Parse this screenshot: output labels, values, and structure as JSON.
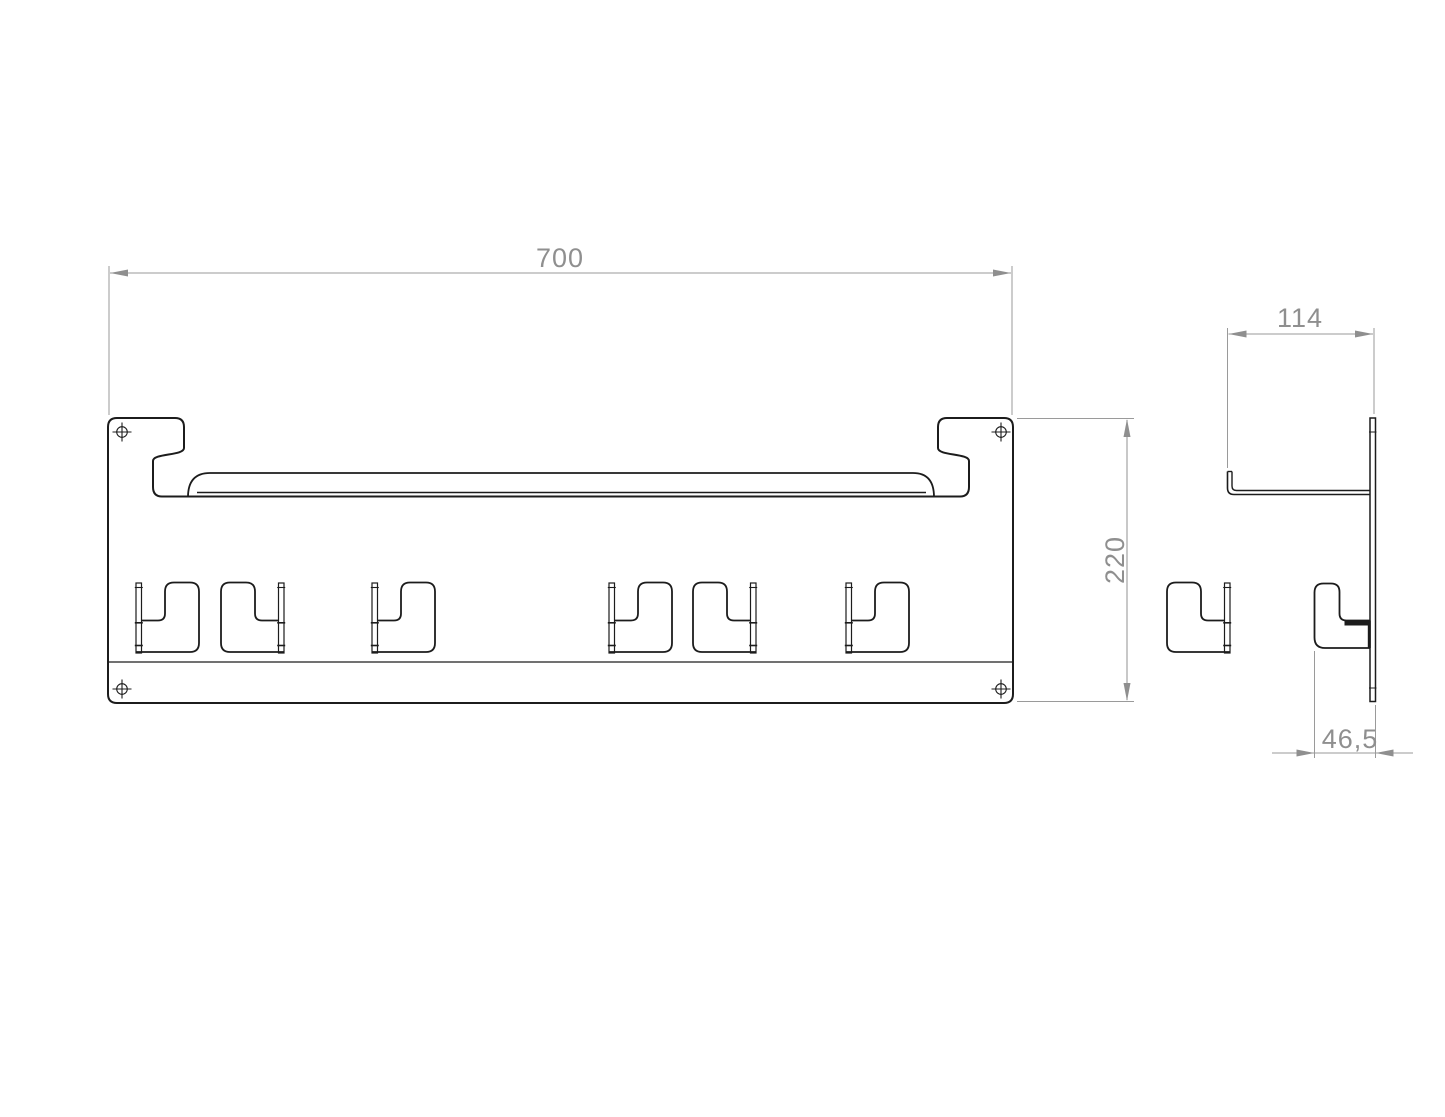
{
  "drawing": {
    "kind": "technical-drawing",
    "background_color": "#ffffff",
    "part_line_color": "#1c1c1c",
    "dimension_color": "#8f8f8f",
    "views": {
      "front_view": {
        "name": "wall rack front view",
        "mounting_hole_count": 4,
        "hook_pair_count": 4,
        "dimensions": {
          "width": {
            "label": "700"
          },
          "height": {
            "label": "220"
          }
        }
      },
      "side_view": {
        "name": "wall rack side profile view",
        "dimensions": {
          "depth": {
            "label": "114"
          },
          "hook_depth": {
            "label": "46,5"
          }
        }
      }
    }
  }
}
